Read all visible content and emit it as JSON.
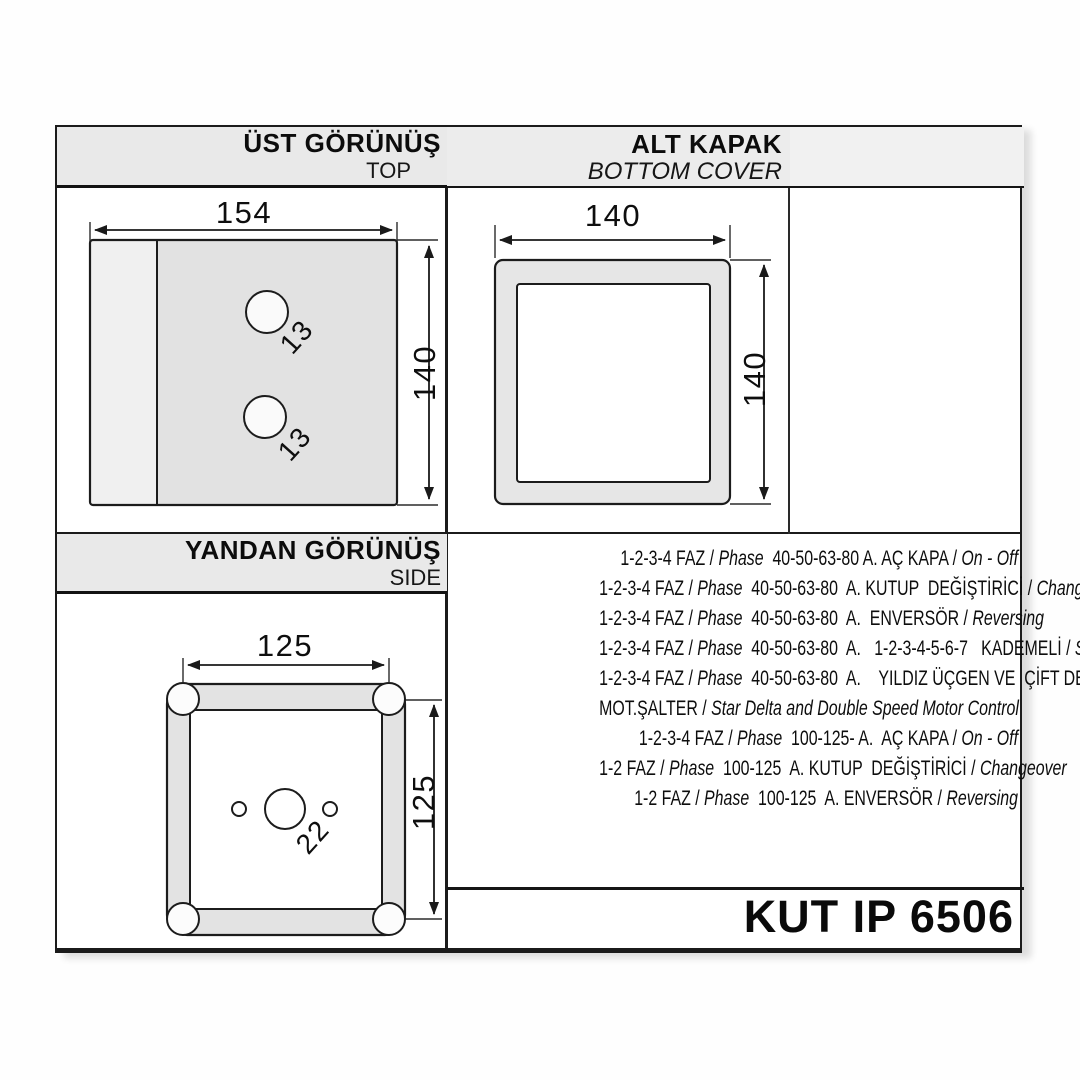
{
  "document": {
    "part_number": "KUT IP 6506"
  },
  "colors": {
    "line": "#1a1a1a",
    "header_band": "#e9e9e9",
    "fill_gray": "#e3e3e3",
    "fill_light": "#f0f0f0",
    "paper": "#ffffff"
  },
  "sections": {
    "top_view": {
      "title": "ÜST GÖRÜNÜŞ",
      "subtitle": "TOP",
      "dim_width": "154",
      "dim_height": "140",
      "hole_labels": [
        "13",
        "13"
      ]
    },
    "bottom_cover": {
      "title": "ALT KAPAK",
      "subtitle": "BOTTOM COVER",
      "dim_width": "140",
      "dim_height": "140"
    },
    "side_view": {
      "title": "YANDAN GÖRÜNÜŞ",
      "subtitle": "SIDE",
      "dim_width": "125",
      "dim_height": "125",
      "hole_label": "22"
    }
  },
  "specs": {
    "lines": [
      [
        [
          "1-2-3-4 FAZ / ",
          0
        ],
        [
          "Phase",
          1
        ],
        [
          "  40-50-63-80 A. AÇ KAPA / ",
          0
        ],
        [
          "On - Off",
          1
        ]
      ],
      [
        [
          "1-2-3-4 FAZ / ",
          0
        ],
        [
          "Phase",
          1
        ],
        [
          "  40-50-63-80  A. KUTUP  DEĞİŞTİRİCİ / ",
          0
        ],
        [
          "Changeover",
          1
        ]
      ],
      [
        [
          "1-2-3-4 FAZ / ",
          0
        ],
        [
          "Phase",
          1
        ],
        [
          "  40-50-63-80  A.  ENVERSÖR / ",
          0
        ],
        [
          "Reversing",
          1
        ]
      ],
      [
        [
          "1-2-3-4 FAZ / ",
          0
        ],
        [
          "Phase",
          1
        ],
        [
          "  40-50-63-80  A.   1-2-3-4-5-6-7   KADEMELİ / ",
          0
        ],
        [
          "Steps",
          1
        ]
      ],
      [
        [
          "1-2-3-4 FAZ / ",
          0
        ],
        [
          "Phase",
          1
        ],
        [
          "  40-50-63-80  A.    YILDIZ ÜÇGEN VE  ÇİFT DEVİR",
          0
        ]
      ],
      [
        [
          "MOT.ŞALTER / ",
          0
        ],
        [
          "Star Delta and Double Speed Motor Control",
          1
        ]
      ],
      [
        [
          "1-2-3-4 FAZ / ",
          0
        ],
        [
          "Phase",
          1
        ],
        [
          "  100-125- A.  AÇ KAPA / ",
          0
        ],
        [
          "On - Off",
          1
        ]
      ],
      [
        [
          "1-2 FAZ / ",
          0
        ],
        [
          "Phase",
          1
        ],
        [
          "  100-125  A. KUTUP  DEĞİŞTİRİCİ / ",
          0
        ],
        [
          "Changeover",
          1
        ]
      ],
      [
        [
          "1-2 FAZ / ",
          0
        ],
        [
          "Phase",
          1
        ],
        [
          "  100-125  A. ENVERSÖR / ",
          0
        ],
        [
          "Reversing",
          1
        ]
      ]
    ]
  }
}
